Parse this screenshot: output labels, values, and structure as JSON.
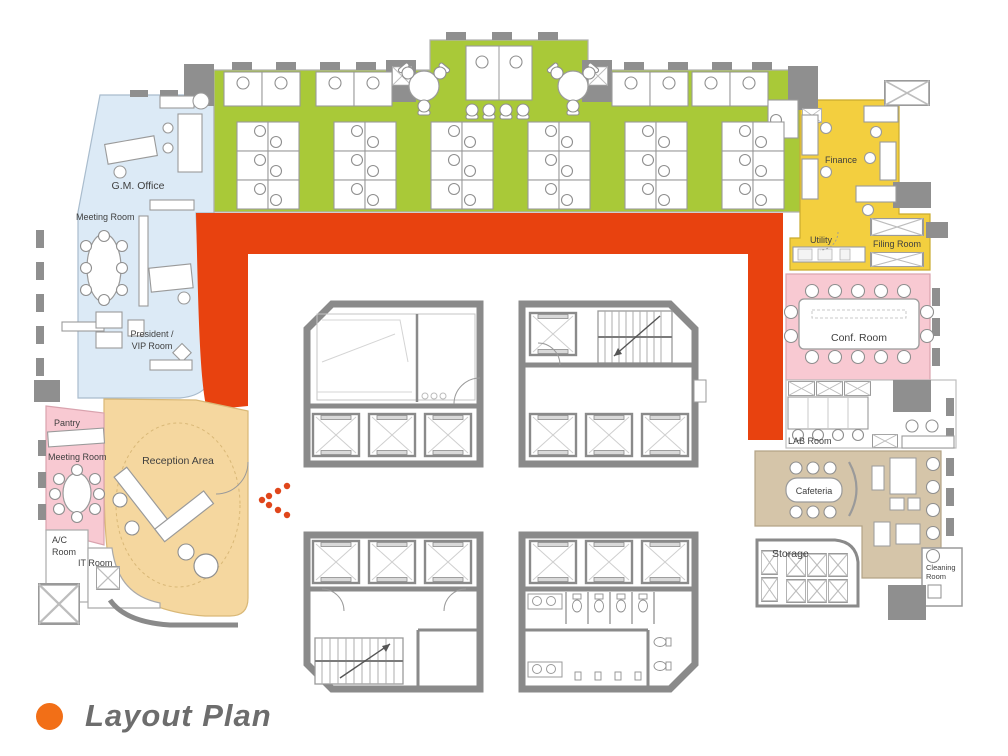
{
  "title": {
    "text": "Layout Plan"
  },
  "palette": {
    "open_office_green": "#A9C938",
    "corridor_red": "#E8420F",
    "executive_blue": "#DCEAF6",
    "pink": "#F8C9D2",
    "reception_tan": "#F5D79F",
    "finance_yellow": "#F3CF3F",
    "cafeteria_tan": "#D5C5A9",
    "wall_gray": "#8A8A8A",
    "accent_orange": "#F26F17",
    "title_gray": "#6D6D6D"
  },
  "rooms": {
    "gm_office": {
      "label": "G.M. Office"
    },
    "meeting_room_upper": {
      "label": "Meeting Room"
    },
    "president_vip": {
      "line1": "President /",
      "line2": "VIP Room"
    },
    "pantry": {
      "label": "Pantry"
    },
    "meeting_room_lower": {
      "label": "Meeting Room"
    },
    "ac_room": {
      "line1": "A/C",
      "line2": "Room"
    },
    "it_room": {
      "label": "IT Room"
    },
    "reception": {
      "label": "Reception Area"
    },
    "finance": {
      "label": "Finance"
    },
    "utility": {
      "label": "Utility"
    },
    "filing_room": {
      "label": "Filing Room"
    },
    "conf_room": {
      "label": "Conf. Room"
    },
    "lab_room": {
      "label": "LAB Room"
    },
    "cafeteria": {
      "label": "Cafeteria"
    },
    "storage": {
      "label": "Storage"
    },
    "cleaning_room": {
      "line1": "Cleaning",
      "line2": "Room"
    }
  }
}
